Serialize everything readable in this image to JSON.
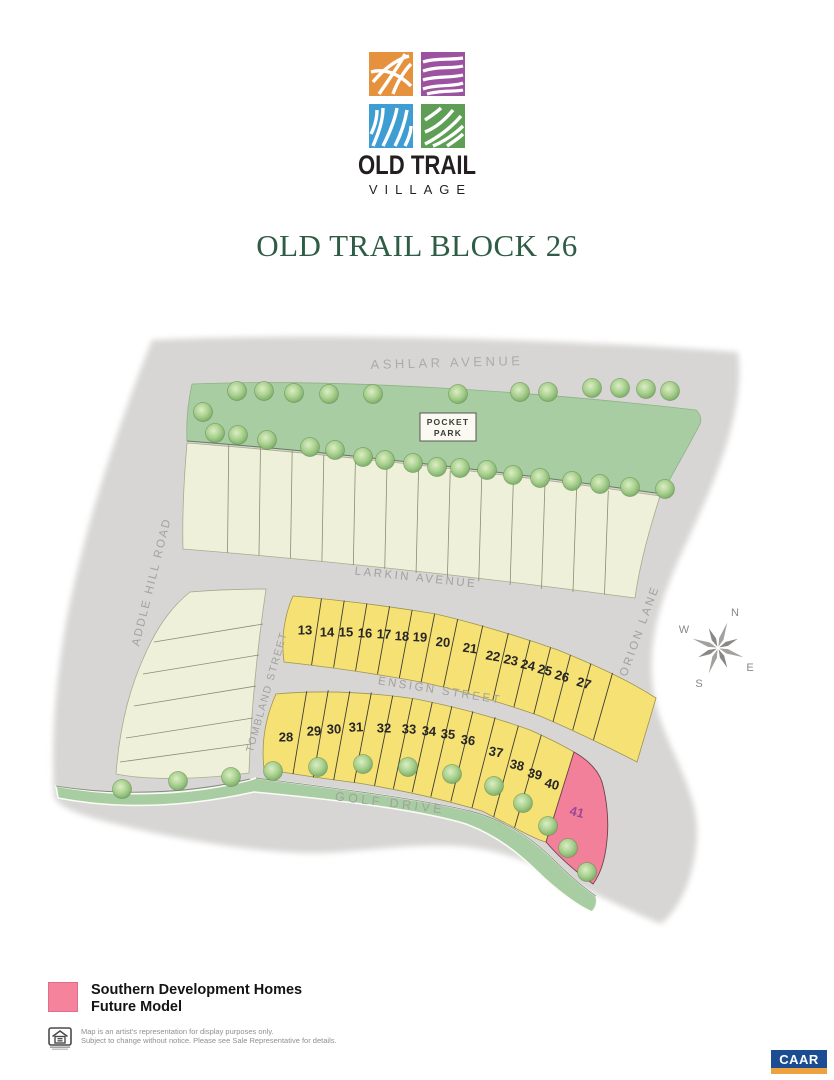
{
  "logo": {
    "name": "OLD TRAIL",
    "subname": "VILLAGE"
  },
  "title": "OLD TRAIL BLOCK 26",
  "map": {
    "streets": {
      "ashlar": "ASHLAR AVENUE",
      "larkin": "LARKIN AVENUE",
      "ensign": "ENSIGN STREET",
      "golf": "GOLF DRIVE",
      "tombland": "TOMBLAND STREET",
      "addle": "ADDLE HILL ROAD",
      "orion": "ORION LANE"
    },
    "pocket_park": [
      "POCKET",
      "PARK"
    ],
    "compass": {
      "n": "N",
      "e": "E",
      "s": "S",
      "w": "W"
    },
    "lots": [
      "13",
      "14",
      "15",
      "16",
      "17",
      "18",
      "19",
      "20",
      "21",
      "22",
      "23",
      "24",
      "25",
      "26",
      "27",
      "28",
      "29",
      "30",
      "31",
      "32",
      "33",
      "34",
      "35",
      "36",
      "37",
      "38",
      "39",
      "40",
      "41"
    ],
    "future_model_lot": "41",
    "colors": {
      "road_gray": "#d7d6d4",
      "park_green": "#a8cda2",
      "lot_cream": "#eef0da",
      "lot_yellow": "#f6e174",
      "future_model_pink": "#f2809b",
      "lot41_label": "#9c4796"
    }
  },
  "legend": {
    "swatch_color": "#f5839c",
    "label_line1": "Southern Development Homes",
    "label_line2": "Future Model",
    "disclaimer_line1": "Map is an artist's representation for display purposes only.",
    "disclaimer_line2": "Subject to change without notice. Please see Sale Representative for details."
  },
  "footer": {
    "caar": "CAAR"
  }
}
